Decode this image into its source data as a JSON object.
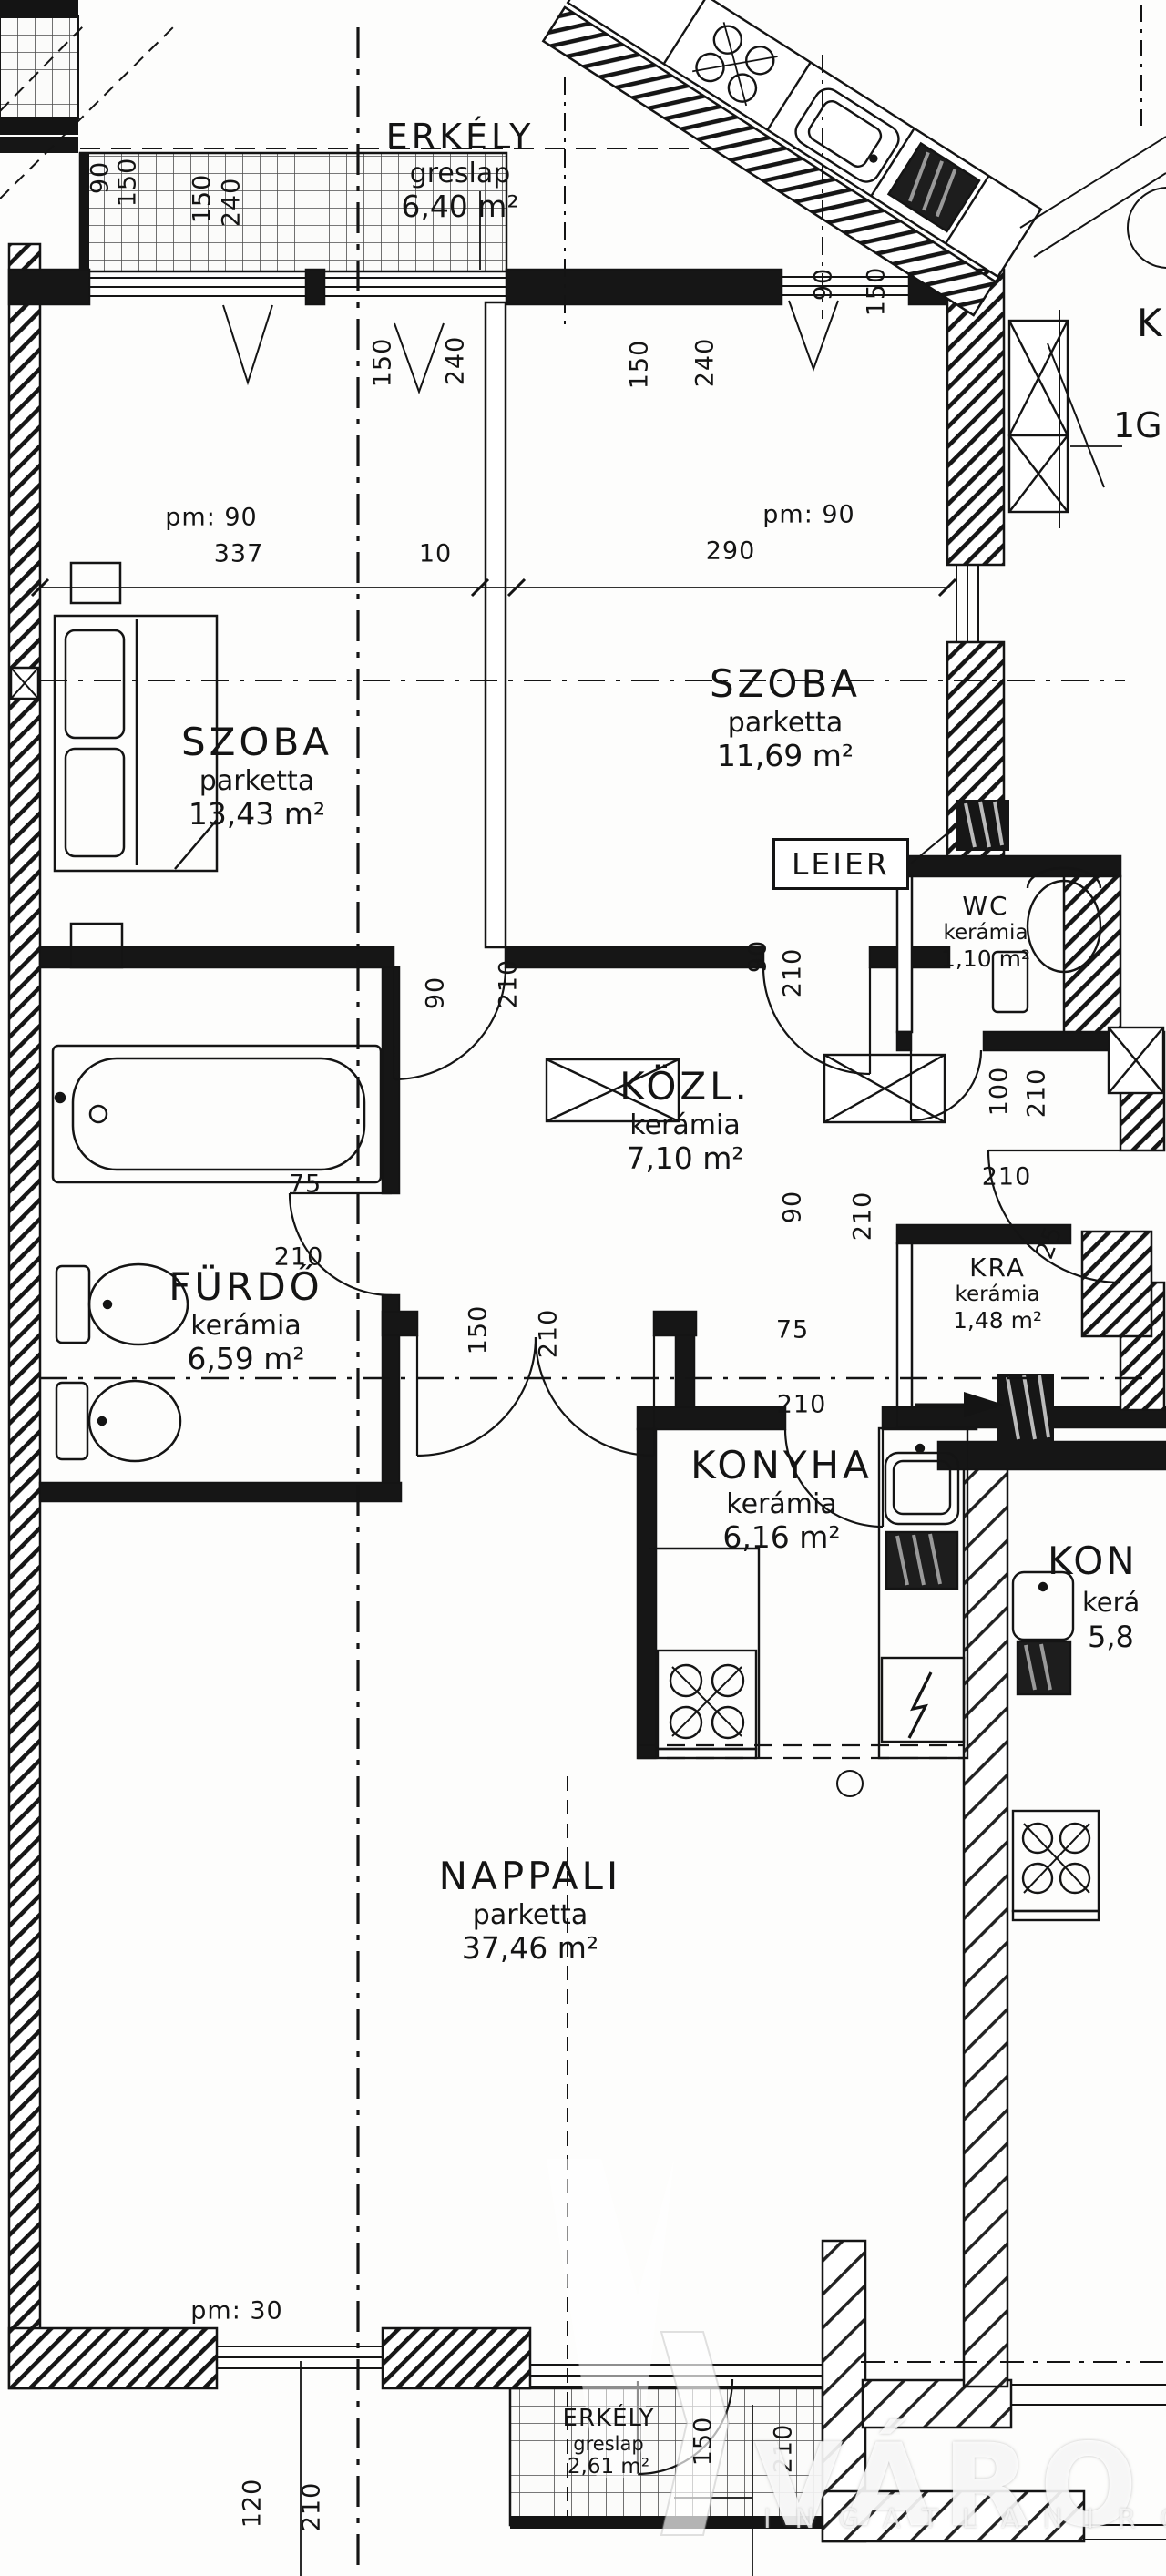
{
  "rooms": {
    "erkely_top": {
      "name": "ERKÉLY",
      "floor": "greslap",
      "area": "6,40 m²"
    },
    "szoba_left": {
      "name": "SZOBA",
      "floor": "parketta",
      "area": "13,43 m²"
    },
    "szoba_right": {
      "name": "SZOBA",
      "floor": "parketta",
      "area": "11,69 m²"
    },
    "wc": {
      "name": "WC",
      "floor": "kerámia",
      "area": "1,10 m²"
    },
    "kozl": {
      "name": "KÖZL.",
      "floor": "kerámia",
      "area": "7,10 m²"
    },
    "furdo": {
      "name": "FÜRDŐ",
      "floor": "kerámia",
      "area": "6,59 m²"
    },
    "kra": {
      "name": "KRA",
      "floor": "kerámia",
      "area": "1,48 m²"
    },
    "konyha": {
      "name": "KONYHA",
      "floor": "kerámia",
      "area": "6,16 m²"
    },
    "nappali": {
      "name": "NAPPALI",
      "floor": "parketta",
      "area": "37,46 m²"
    },
    "erkely_bottom": {
      "name": "ERKÉLY",
      "floor": "greslap",
      "area": "2,61 m²"
    },
    "neighbor_konyha": {
      "name": "KON",
      "floor": "kerá",
      "area": "5,8"
    }
  },
  "labels": {
    "leier": "LEIER",
    "k_partial": "K",
    "g_partial": "1G"
  },
  "dims": [
    "90",
    "150",
    "150",
    "240",
    "150",
    "240",
    "150",
    "240",
    "90",
    "150",
    "pm: 90",
    "337",
    "10",
    "pm: 90",
    "290",
    "90",
    "210",
    "90",
    "210",
    "75",
    "210",
    "90",
    "210",
    "75",
    "210",
    "210",
    "25",
    "100",
    "210",
    "150",
    "210",
    "pm: 30",
    "120",
    "210",
    "150",
    "210"
  ],
  "watermark": {
    "brand": "VÁRO",
    "sub": "INGATLANIRODA"
  }
}
